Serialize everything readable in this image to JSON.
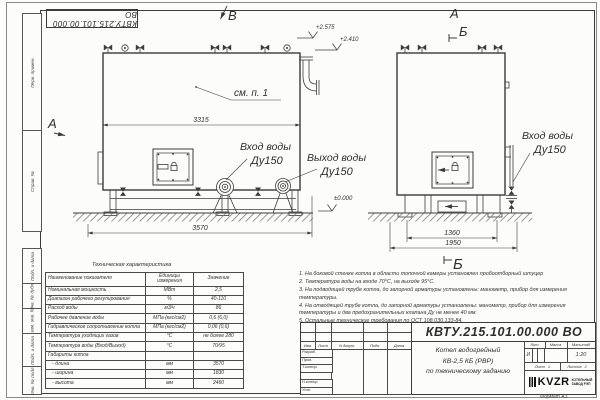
{
  "sheet": {
    "stamp_top": "КВТУ.215.101.00.000 ВО",
    "format_label": "Формат А3"
  },
  "margin_labels": [
    "Перв. примен.",
    "Справ. №",
    "Подп. и дата",
    "Инв. № дубл.",
    "Взам. инв. №",
    "Подп. и дата",
    "Инв. № подл."
  ],
  "drawing": {
    "view_b": "В",
    "view_a_front": "А",
    "view_a_side": "А",
    "section_b_top": "Б",
    "section_b_bottom": "Б",
    "see_note": "см. п. 1",
    "dims": {
      "boiler_width": "3315",
      "overall_length": "3570",
      "frame_width": "1360",
      "overall_width": "1950"
    },
    "elevations": {
      "top1": "+2.575",
      "top2": "+2.410",
      "ground": "±0.000"
    },
    "labels": {
      "front_inlet": "Вход воды",
      "front_inlet_dn": "Ду150",
      "front_outlet": "Выход воды",
      "front_outlet_dn": "Ду150",
      "side_inlet": "Вход воды",
      "side_inlet_dn": "Ду150"
    }
  },
  "spec_table": {
    "title": "Техническая характеристика",
    "headers": [
      "Наименование показателя",
      "Единицы измерения",
      "Значение"
    ],
    "rows": [
      [
        "Номинальная мощность",
        "МВт",
        "2,5"
      ],
      [
        "Диапазон рабочего регулирования",
        "%",
        "40-110"
      ],
      [
        "Расход воды",
        "м3/ч",
        "86"
      ],
      [
        "Рабочее давление воды",
        "МПа (кгс/см2)",
        "0,6 (6,0)"
      ],
      [
        "Гидравлическое сопротивление котла",
        "МПа (кгс/см2)",
        "0,06 (0,6)"
      ],
      [
        "Температура уходящих газов",
        "°С",
        "не более 280"
      ],
      [
        "Температура воды (Вход/Выход)",
        "°С",
        "70/95"
      ],
      [
        "Габариты котла",
        "",
        ""
      ],
      [
        "   - длина",
        "мм",
        "3570"
      ],
      [
        "   - ширина",
        "мм",
        "1830"
      ],
      [
        "   - высота",
        "мм",
        "2460"
      ]
    ]
  },
  "notes": [
    "1. На боковой стенке котла в области топочной камеры установлен пробоотборный штуцер",
    "2. Температура воды на входе 70°С, на выходе 95°С.",
    "3. На подводящей трубе котла, до запорной арматуры установлены: манометр, прибор для измерения температуры.",
    "4. На отводящей трубе котла, до запорной арматуры установлены: манометр, прибор для измерения температуры и два предохранительных клапана Ду не менее 40 мм.",
    "5. Остальные технические требования по ОСТ 108.030.133-84."
  ],
  "title_block": {
    "doc_number": "КВТУ.215.101.00.000  ВО",
    "product_title": [
      "Котел водогрейный",
      "КВ-2,5 КБ (РВР)",
      "по техническому заданию"
    ],
    "cols": [
      "Изм.",
      "Лист",
      "N докум.",
      "Подп.",
      "Дата"
    ],
    "roles": [
      "Разраб.",
      "Пров.",
      "Т.контр.",
      "Н.контр.",
      "Утв."
    ],
    "lit": {
      "label": "Лит.",
      "value": "И"
    },
    "mass": {
      "label": "Масса",
      "value": ""
    },
    "scale": {
      "label": "Масштаб",
      "value": "1:20"
    },
    "sheet_no": {
      "label": "Лист",
      "value": "1"
    },
    "sheets": {
      "label": "Листов",
      "value": "2"
    },
    "logo": {
      "name": "KVZR",
      "sub1": "КОТЕЛЬНЫЙ",
      "sub2": "ЗАВОД РЭП"
    }
  }
}
